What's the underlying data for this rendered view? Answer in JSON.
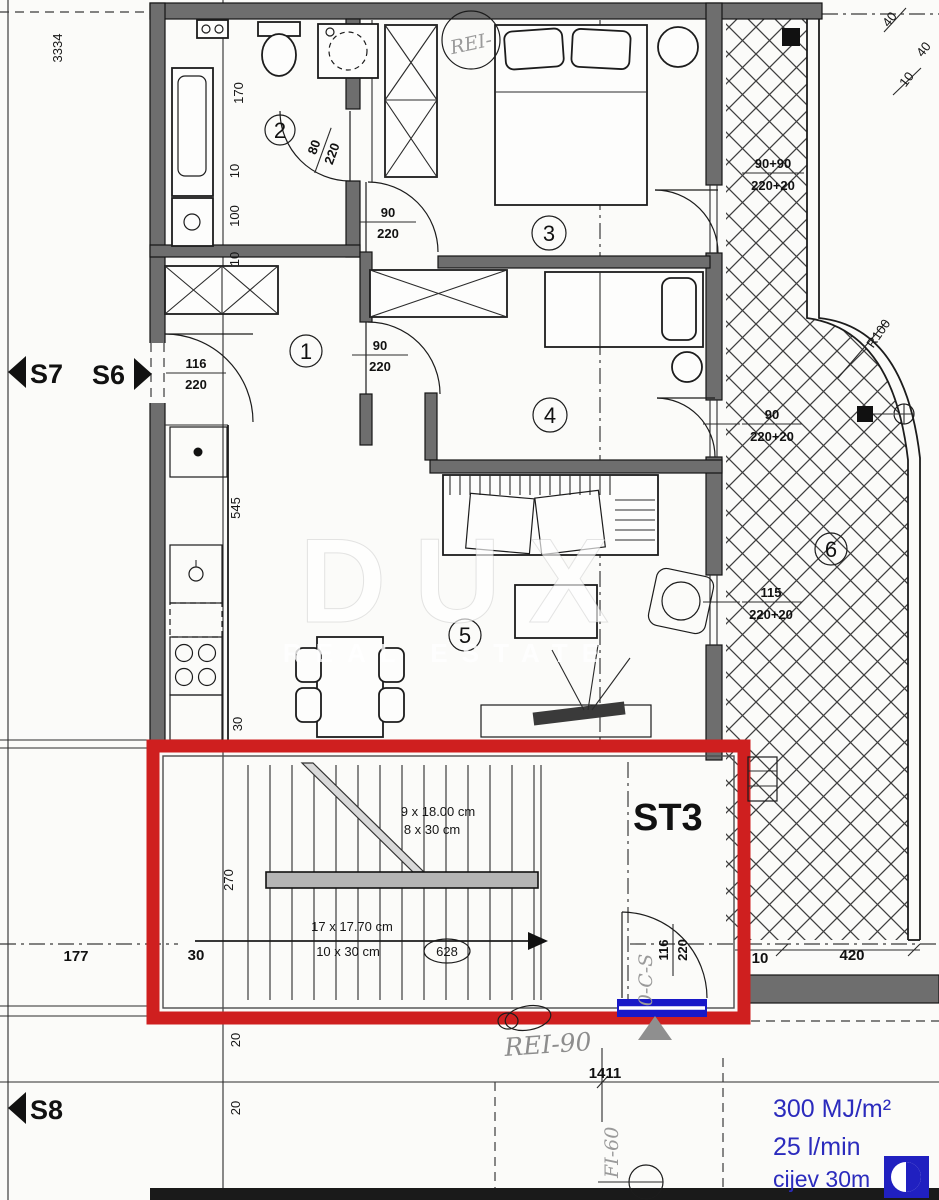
{
  "plan": {
    "section_markers": {
      "s7": "S7",
      "s6": "S6",
      "s8": "S8"
    },
    "stair_label": "ST3",
    "room_numbers": {
      "r1": "1",
      "r2": "2",
      "r3": "3",
      "r4": "4",
      "r5": "5",
      "r6": "6"
    },
    "watermark": {
      "line1": "DUX",
      "line2": "REAL ESTATE"
    },
    "doors": {
      "entrance": {
        "top": "116",
        "bottom": "220"
      },
      "bathroom": {
        "top": "80",
        "bottom": "220"
      },
      "room3": {
        "top": "90",
        "bottom": "220"
      },
      "room4": {
        "top": "90",
        "bottom": "220"
      },
      "room3_terrace": {
        "top": "90+90",
        "bottom": "220+20"
      },
      "room4_terrace": {
        "top": "90",
        "bottom": "220+20"
      },
      "living_window": {
        "top": "115",
        "bottom": "220+20"
      },
      "stairwell": {
        "top": "116",
        "bottom": "220"
      }
    },
    "dimensions": {
      "left_total": "3334",
      "bath_170": "170",
      "bath_10a": "10",
      "bath_100": "100",
      "bath_10b": "10",
      "kitchen_545": "545",
      "kitchen_30": "30",
      "stair_270": "270",
      "stair_30": "30",
      "stair_177": "177",
      "bottom_1411": "1411",
      "bottom_20a": "20",
      "bottom_20b": "20",
      "terrace_10": "10",
      "terrace_420": "420",
      "tr_40a": "40",
      "tr_40b": "40",
      "tr_10": "10"
    },
    "stairs": {
      "flight1_riser": "9 x 18.00 cm",
      "flight1_tread": "8 x 30 cm",
      "flight2_riser": "17 x 17.70 cm",
      "flight2_tread": "10 x 30 cm",
      "going": "628"
    },
    "curve_radius": "R100",
    "fire": {
      "rei90": "REI-90",
      "rei_top": "REI-",
      "fi60": "FI-60",
      "duct": "0-C-S"
    },
    "hydrant": {
      "heat_load": "300 MJ/m²",
      "flow": "25 l/min",
      "pipe": "cijev 30m"
    },
    "colors": {
      "highlight_red": "#cf1f1f",
      "sill_blue": "#1818c8",
      "note_blue": "#2b2bbd",
      "wall_gray": "#6e6e6e"
    }
  }
}
